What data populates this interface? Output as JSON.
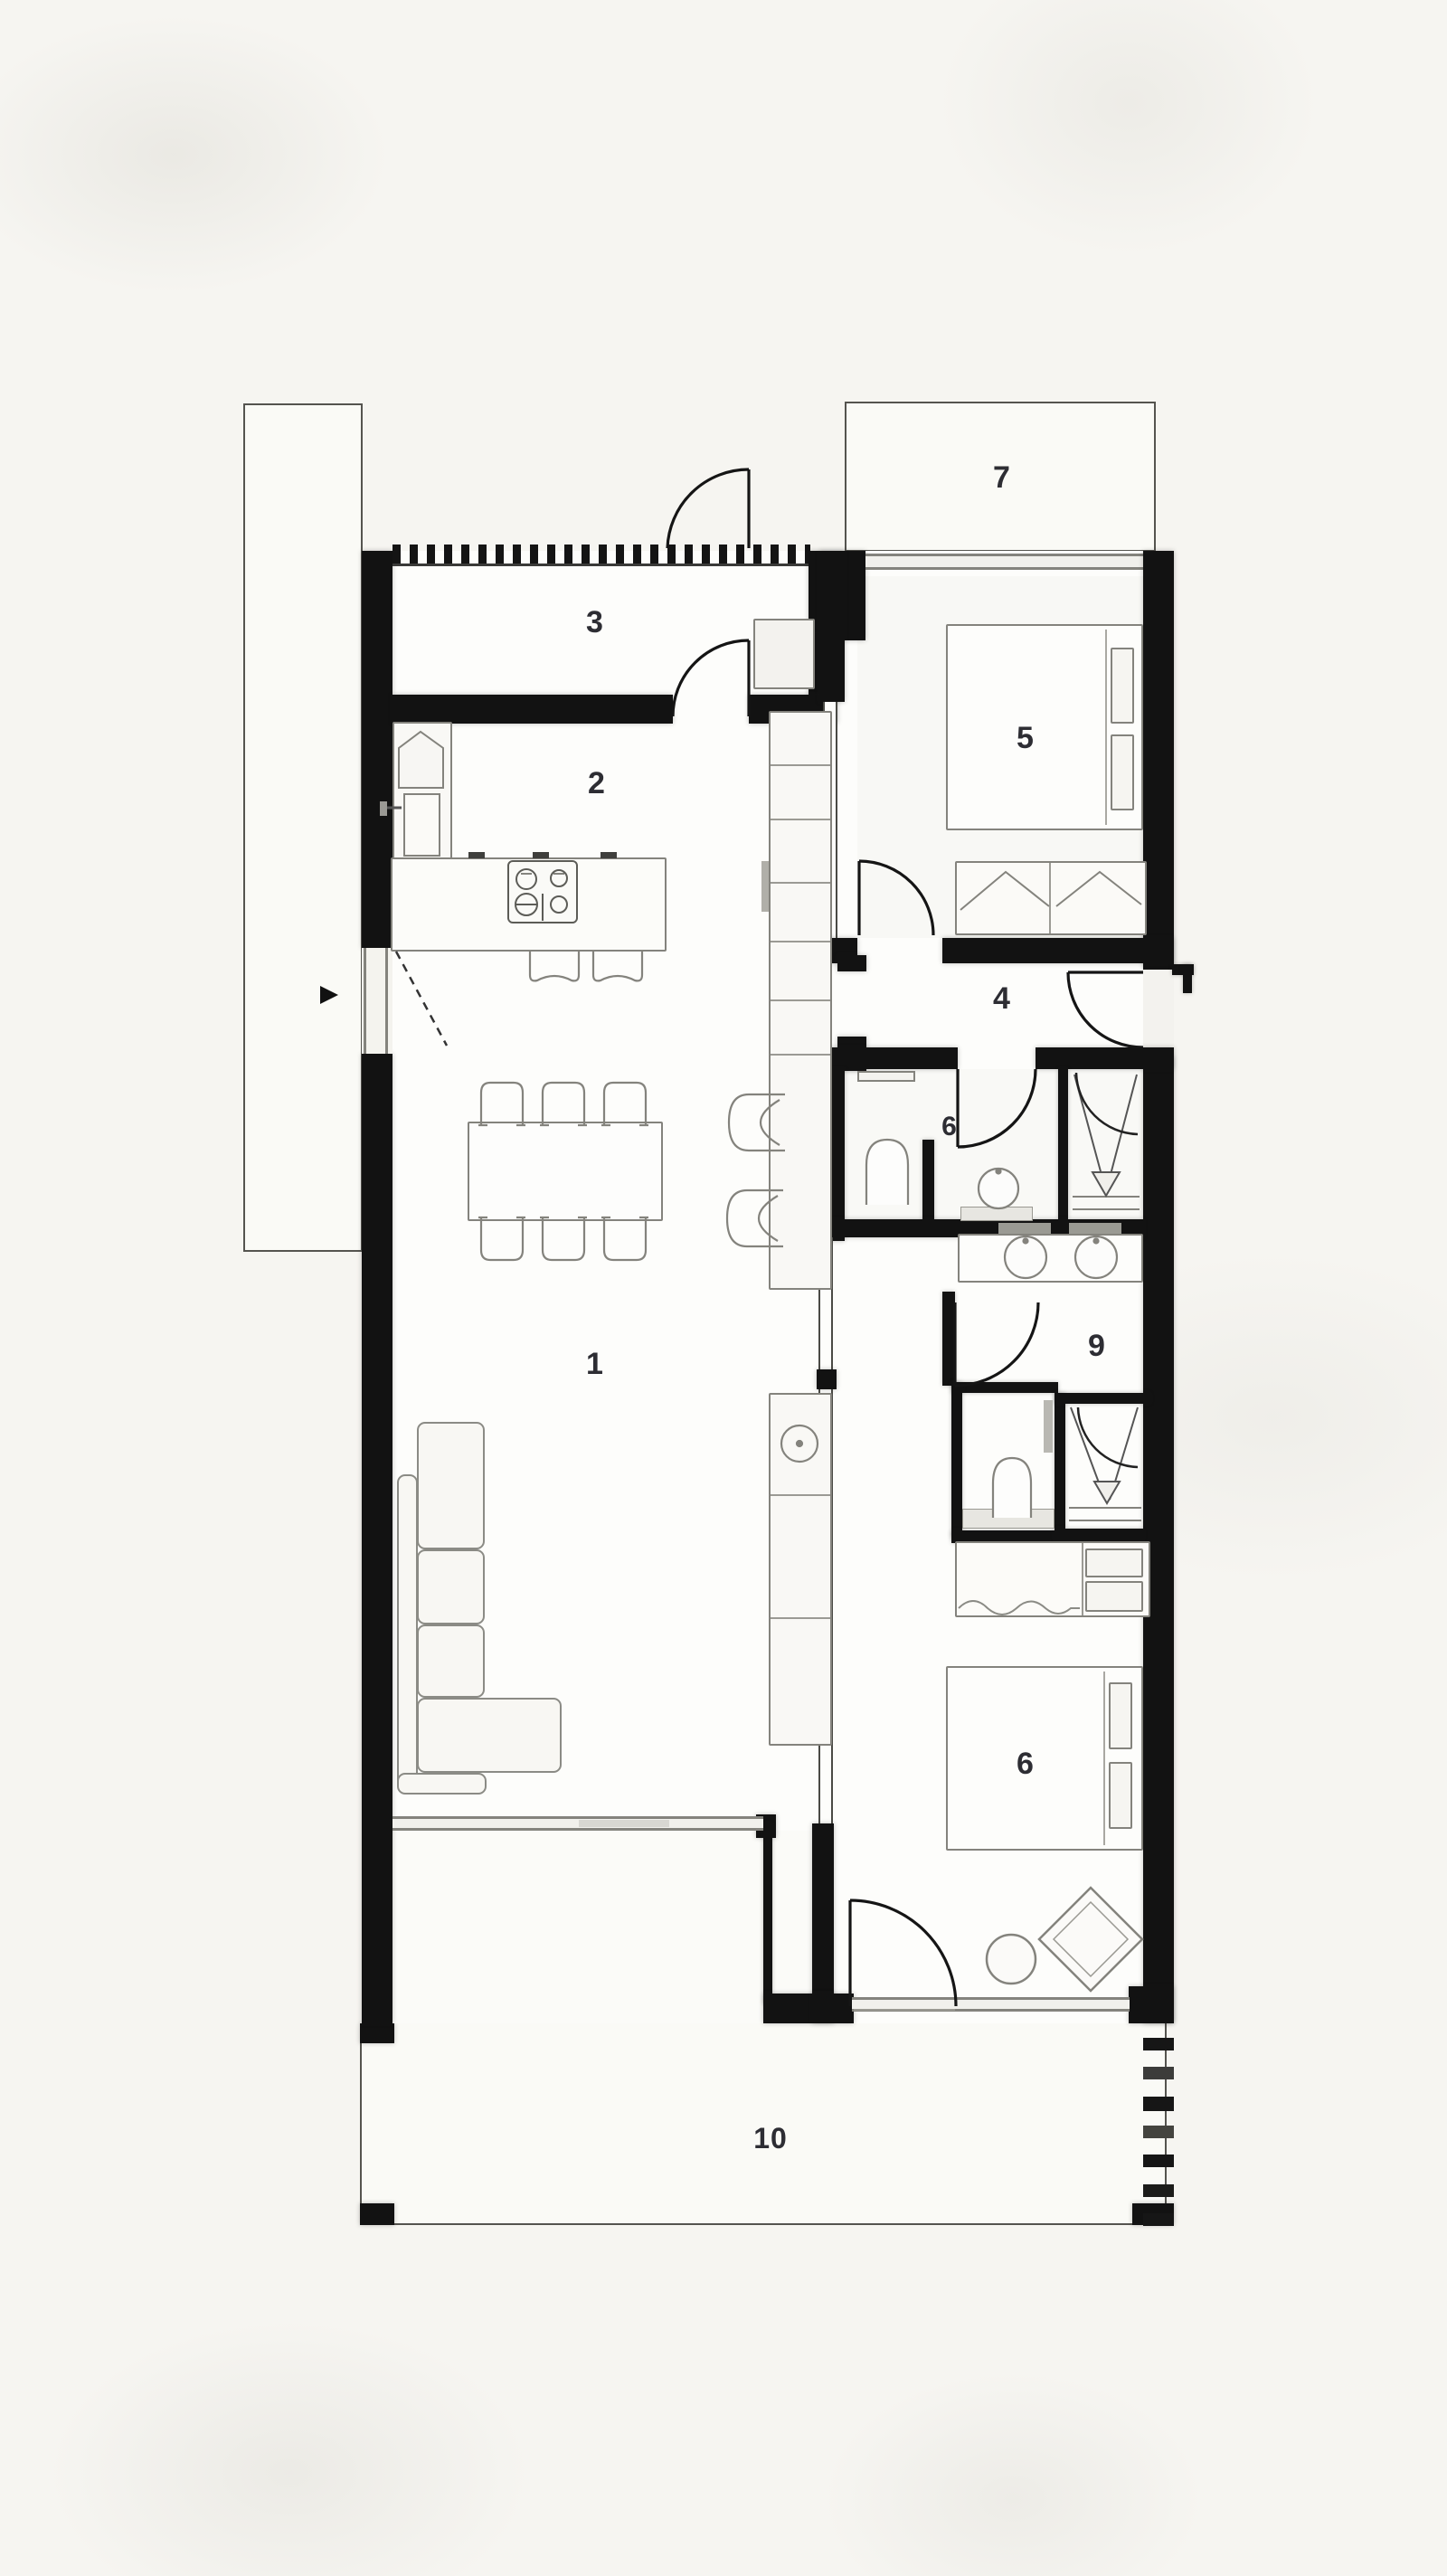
{
  "plan": {
    "title": "apartment-floor-plan",
    "rooms": [
      {
        "id": "living-room",
        "label": "1"
      },
      {
        "id": "kitchen",
        "label": "2"
      },
      {
        "id": "storage-room",
        "label": "3"
      },
      {
        "id": "hallway",
        "label": "4"
      },
      {
        "id": "bedroom-1",
        "label": "5"
      },
      {
        "id": "bathroom",
        "label": "6"
      },
      {
        "id": "balcony",
        "label": "7"
      },
      {
        "id": "dressing-ensuite",
        "label": "9"
      },
      {
        "id": "bedroom-2",
        "label": "6"
      },
      {
        "id": "terrace",
        "label": "10"
      }
    ],
    "fixtures": [
      "entrance-arrow-icon",
      "dining-table",
      "dining-chair",
      "sofa-sectional",
      "kitchen-island",
      "hob-4-burner",
      "kitchen-sink",
      "bar-stool",
      "tall-cabinet",
      "washing-machine",
      "bed-double",
      "wardrobe",
      "toilet",
      "washbasin",
      "shower",
      "towel-radiator",
      "round-side-table",
      "diamond-lounge-chair",
      "door-swing",
      "window-band",
      "boundary-hatch"
    ],
    "colors": {
      "wall": "#121212",
      "furniture-line": "#84837d",
      "thin-outline": "#55544f",
      "paper": "#f6f5f1",
      "interior": "#fdfdfb",
      "label": "#2d2d33"
    }
  }
}
